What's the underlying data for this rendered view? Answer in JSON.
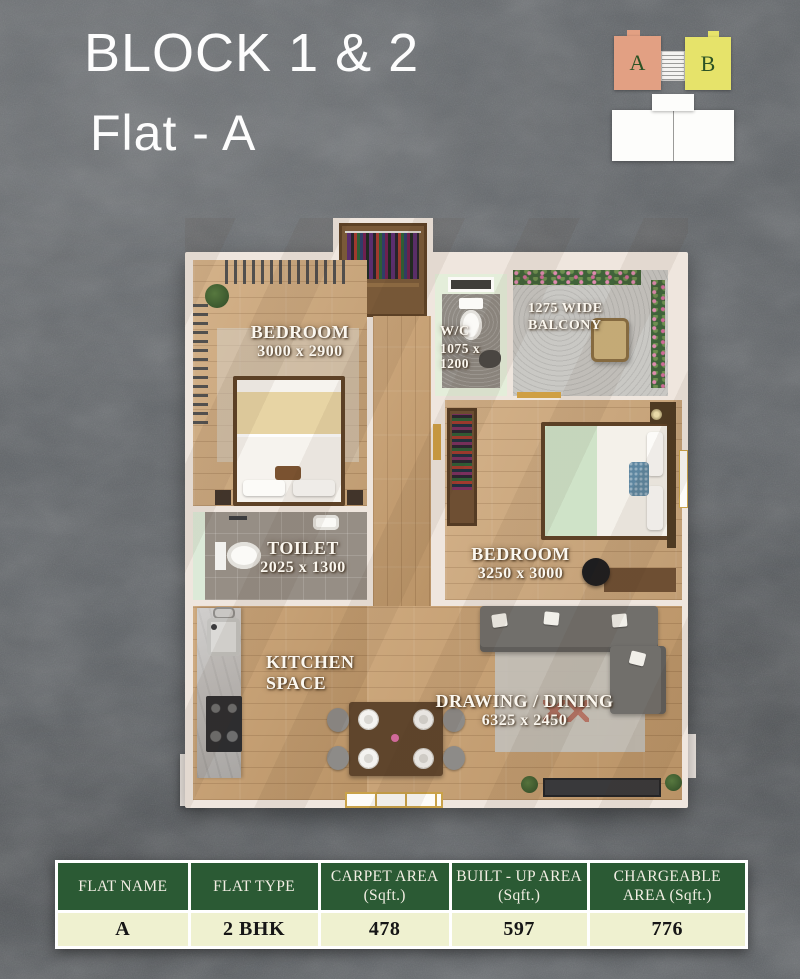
{
  "header": {
    "title": "BLOCK 1 & 2",
    "subtitle": "Flat - A"
  },
  "key_plan": {
    "block_a_label": "A",
    "block_b_label": "B"
  },
  "rooms": {
    "bedroom1": {
      "name": "BEDROOM",
      "dims": "3000 x 2900"
    },
    "wc": {
      "name": "W/C",
      "dims_line1": "1075 x",
      "dims_line2": "1200"
    },
    "balcony": {
      "line1": "1275 WIDE",
      "line2": "BALCONY"
    },
    "toilet": {
      "name": "TOILET",
      "dims": "2025 x 1300"
    },
    "bedroom2": {
      "name": "BEDROOM",
      "dims": "3250 x 3000"
    },
    "kitchen": {
      "line1": "KITCHEN",
      "line2": "SPACE"
    },
    "drawing": {
      "name": "DRAWING / DINING",
      "dims": "6325 x 2450"
    }
  },
  "table": {
    "headers": [
      "FLAT NAME",
      "FLAT TYPE",
      "CARPET AREA (Sqft.)",
      "BUILT - UP AREA (Sqft.)",
      "CHARGEABLE AREA (Sqft.)"
    ],
    "rows": [
      [
        "A",
        "2 BHK",
        "478",
        "597",
        "776"
      ]
    ]
  },
  "colors": {
    "block_a": "#e2a083",
    "block_b": "#e6e36a",
    "table_header_green": "#2b5a34",
    "table_row_cream": "#eff1d0"
  }
}
